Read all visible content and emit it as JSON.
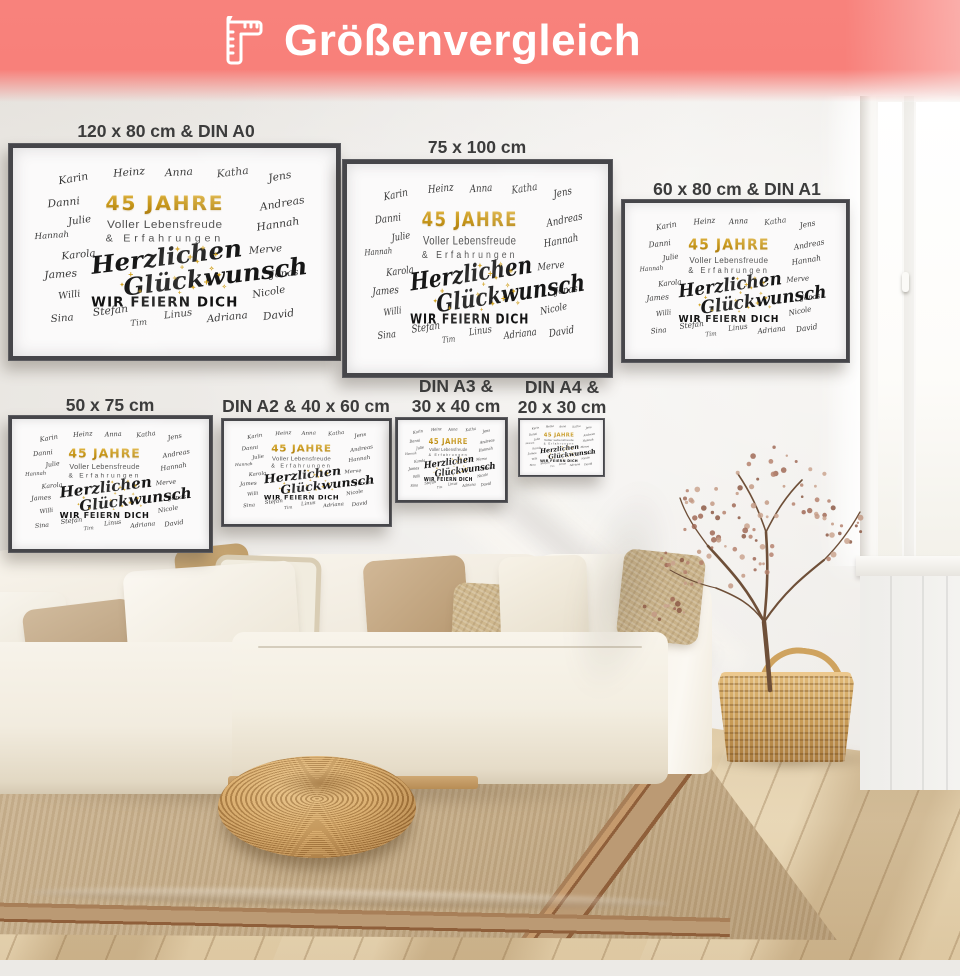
{
  "header": {
    "title": "Größenvergleich",
    "icon": "ruler-icon",
    "background_color": "#f8807a",
    "text_color": "#ffffff"
  },
  "poster": {
    "names": [
      "Karin",
      "Heinz",
      "Anna",
      "Katha",
      "Jens",
      "Danni",
      "Andreas",
      "Julie",
      "Hannah",
      "Hannah",
      "Karola",
      "Merve",
      "James",
      "Jonas",
      "Willi",
      "Nicole",
      "Sina",
      "Stefan",
      "Tim",
      "Linus",
      "Adriana",
      "David"
    ],
    "headline": "45 JAHRE",
    "subline1": "Voller Lebensfreude",
    "subline2": "& Erfahrungen",
    "script_line1": "Herzlichen",
    "script_line2": "Glückwunsch",
    "footer_line": "WIR FEIERN DICH",
    "gold_color": "#d1a01d",
    "text_color": "#4e4e4e",
    "script_color": "#161616"
  },
  "size_labels": [
    {
      "text": "120 x 80 cm & DIN A0"
    },
    {
      "text": "75 x 100 cm"
    },
    {
      "text": "60 x 80 cm & DIN A1"
    },
    {
      "text": "50 x 75 cm"
    },
    {
      "text": "DIN A2 & 40 x 60 cm"
    },
    {
      "text": "DIN A3 &\n30 x 40 cm"
    },
    {
      "text": "DIN A4 &\n20 x 30 cm"
    }
  ]
}
